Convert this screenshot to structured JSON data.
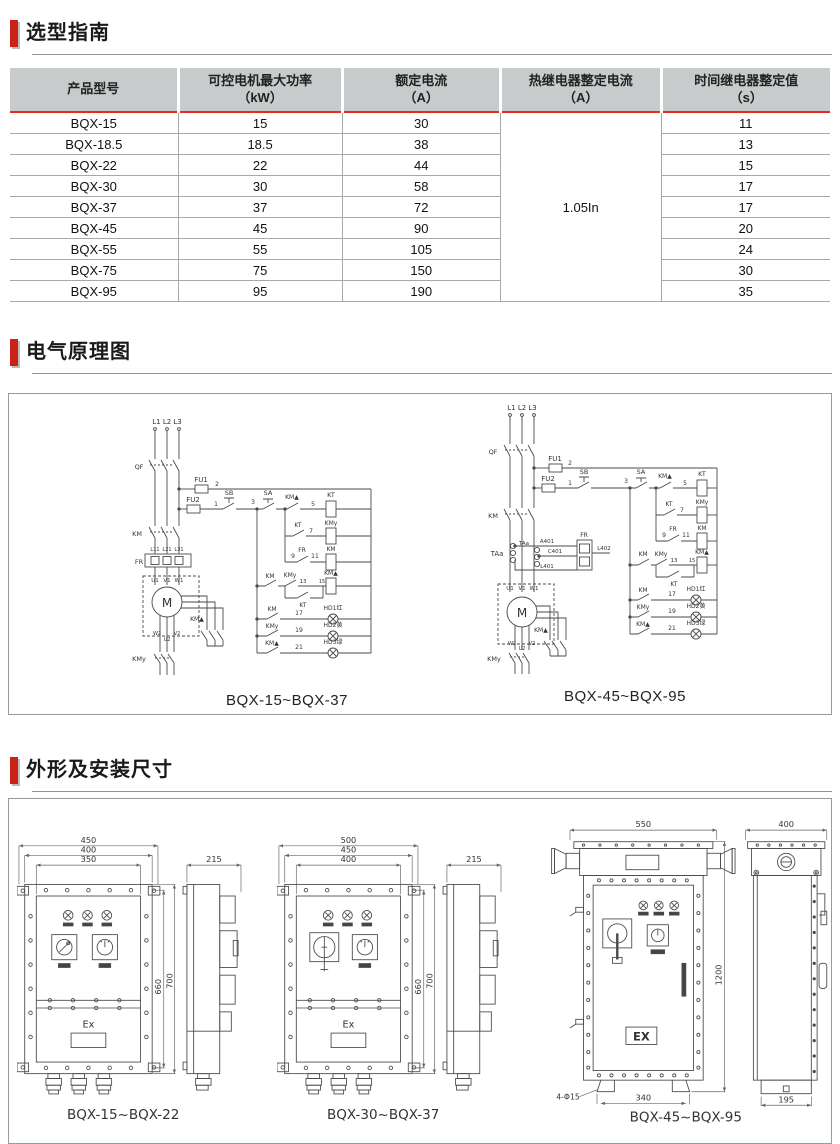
{
  "page": {
    "accent_red": "#cb2218",
    "table_header_bg": "#c7cbcc",
    "red_line": "#e8291c"
  },
  "sections": {
    "guide": "选型指南",
    "schematic": "电气原理图",
    "dimensions": "外形及安装尺寸"
  },
  "table": {
    "headers": [
      {
        "title": "产品型号",
        "unit": ""
      },
      {
        "title": "可控电机最大功率",
        "unit": "（kW）"
      },
      {
        "title": "额定电流",
        "unit": "（A）"
      },
      {
        "title": "热继电器整定电流",
        "unit": "（A）"
      },
      {
        "title": "时间继电器整定值",
        "unit": "（s）"
      }
    ],
    "merged_thermal_value": "1.05In",
    "rows": [
      {
        "model": "BQX-15",
        "kw": "15",
        "a": "30",
        "s": "11"
      },
      {
        "model": "BQX-18.5",
        "kw": "18.5",
        "a": "38",
        "s": "13"
      },
      {
        "model": "BQX-22",
        "kw": "22",
        "a": "44",
        "s": "15"
      },
      {
        "model": "BQX-30",
        "kw": "30",
        "a": "58",
        "s": "17"
      },
      {
        "model": "BQX-37",
        "kw": "37",
        "a": "72",
        "s": "17"
      },
      {
        "model": "BQX-45",
        "kw": "45",
        "a": "90",
        "s": "20"
      },
      {
        "model": "BQX-55",
        "kw": "55",
        "a": "105",
        "s": "24"
      },
      {
        "model": "BQX-75",
        "kw": "75",
        "a": "150",
        "s": "30"
      },
      {
        "model": "BQX-95",
        "kw": "95",
        "a": "190",
        "s": "35"
      }
    ]
  },
  "schematics": {
    "labels": {
      "l123": "L1 L2 L3",
      "qf": "QF",
      "fu1": "FU1",
      "fu2": "FU2",
      "sb": "SB",
      "sa": "SA",
      "km": "KM",
      "kmy": "KMy",
      "kmd": "KM▲",
      "kt": "KT",
      "fr": "FR",
      "m": "M",
      "n1": "1",
      "n2": "2",
      "n3": "3",
      "n5": "5",
      "n7": "7",
      "n9": "9",
      "n11": "11",
      "n13": "13",
      "n15": "15",
      "n17": "17",
      "n19": "19",
      "n21": "21",
      "l11": "L11",
      "l21": "L21",
      "l31": "L31",
      "u1": "U1",
      "v1": "V1",
      "w1": "W1",
      "w2": "W2",
      "u2": "U2",
      "v2": "V2",
      "hd1": "HD1红",
      "hd2": "HD2黄",
      "hd3": "HD3绿",
      "taa": "TAa",
      "a401": "A401",
      "c401": "C401",
      "l401": "L401",
      "l402": "L402"
    },
    "left_caption": "BQX-15~BQX-37",
    "right_caption": "BQX-45~BQX-95"
  },
  "drawings": {
    "g1": {
      "caption": "BQX-15~BQX-22",
      "w1": "450",
      "w2": "400",
      "w3": "350",
      "h1": "660",
      "h2": "700",
      "d": "215",
      "ex": "Ex"
    },
    "g2": {
      "caption": "BQX-30~BQX-37",
      "w1": "500",
      "w2": "450",
      "w3": "400",
      "h1": "660",
      "h2": "700",
      "d": "215",
      "ex": "Ex"
    },
    "g3": {
      "caption": "BQX-45~BQX-95",
      "w": "550",
      "h": "1200",
      "bottom": "340",
      "holes": "4-Φ15",
      "d": "400",
      "d_bottom": "195",
      "ex": "EX"
    }
  }
}
